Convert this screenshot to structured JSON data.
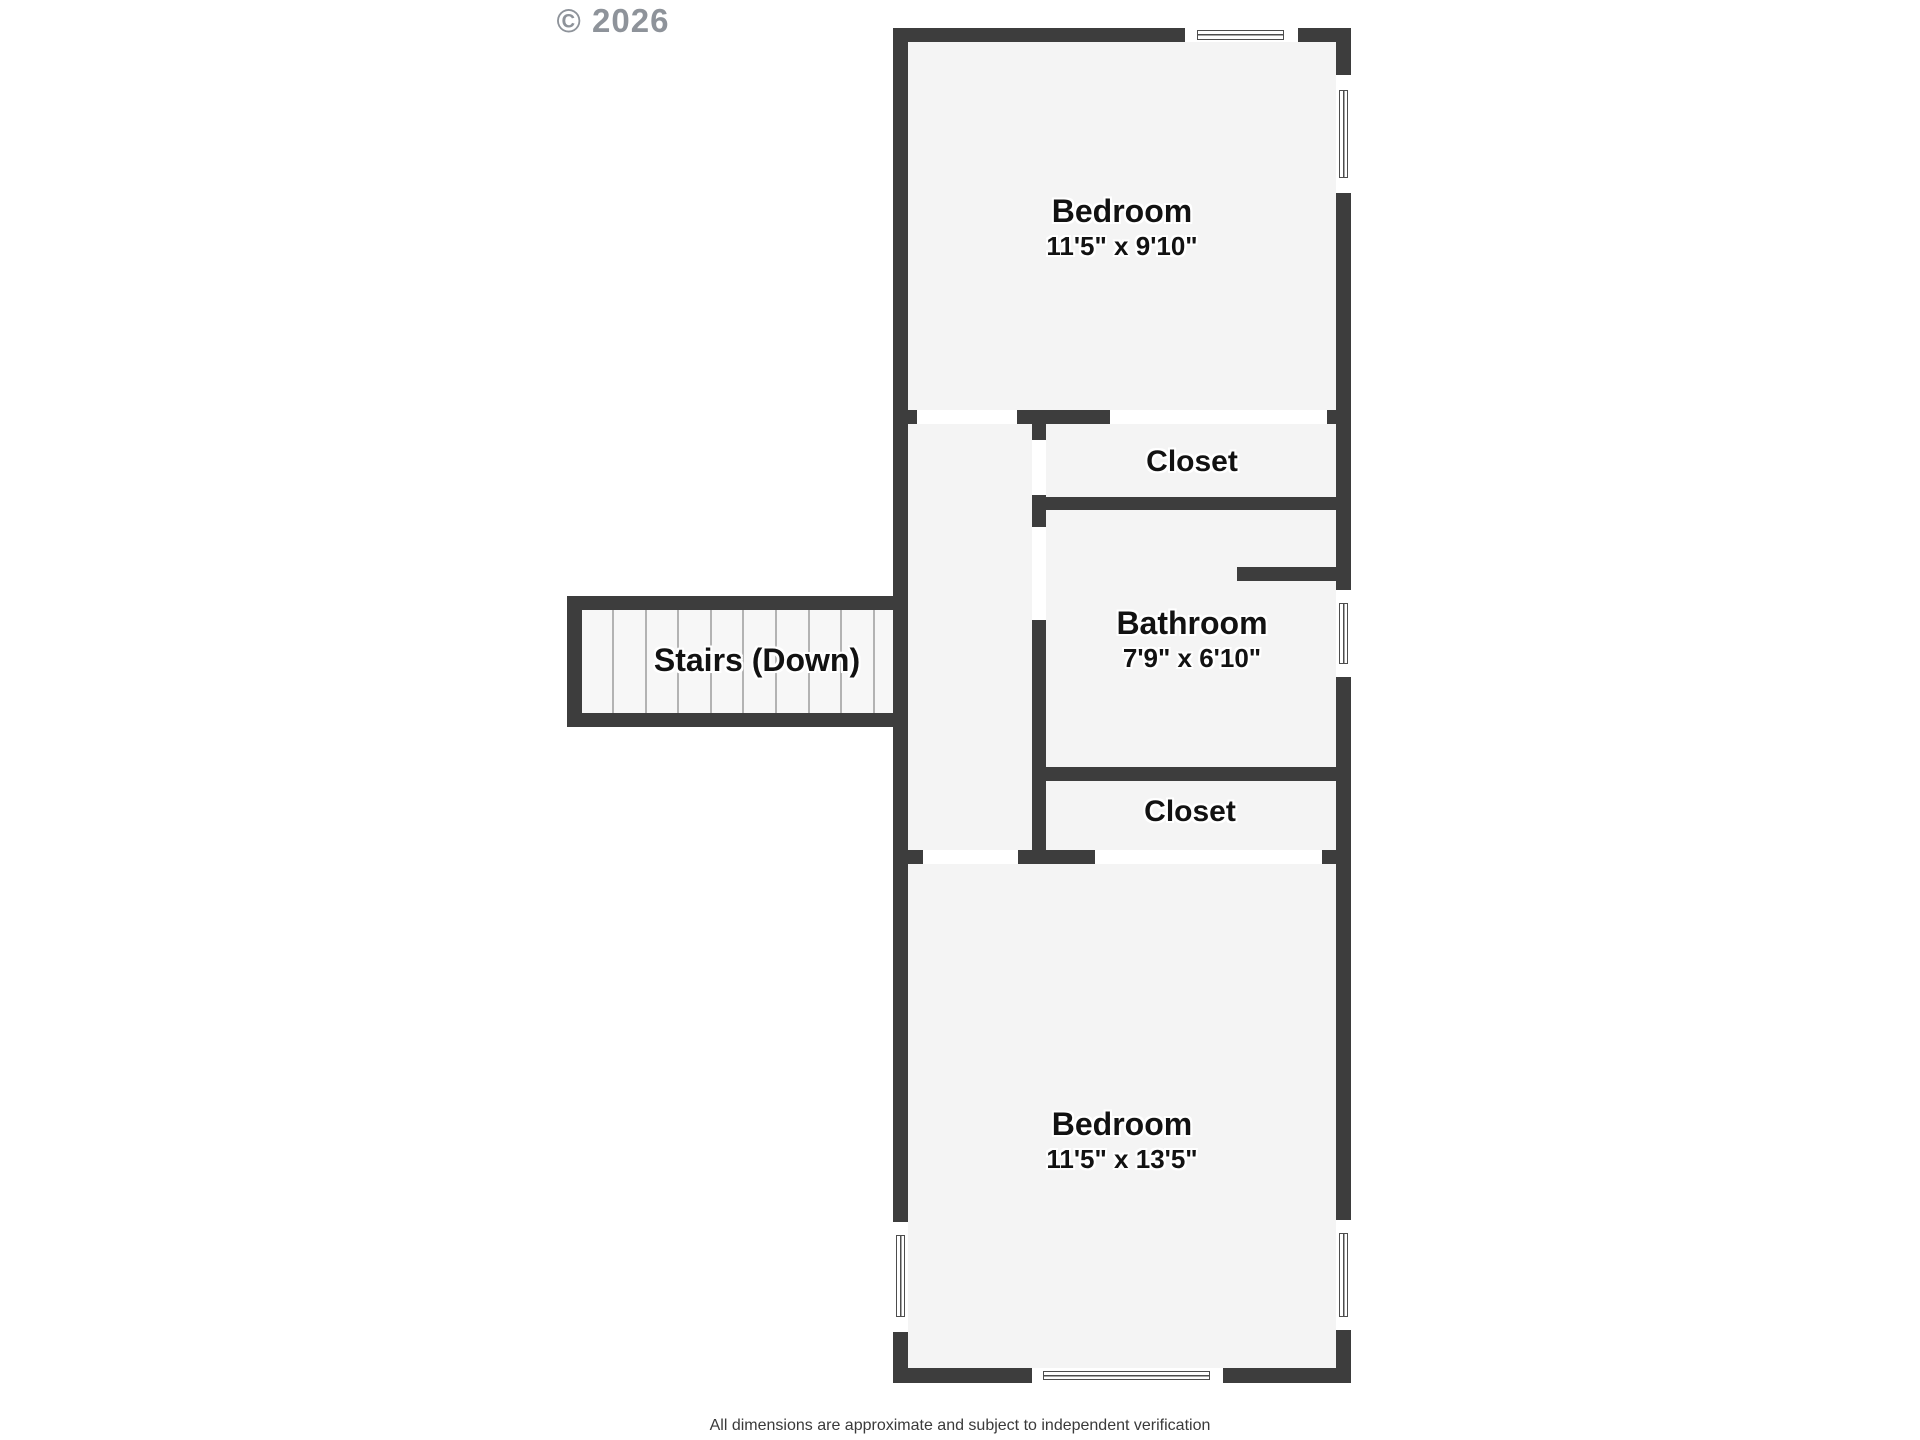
{
  "copyright": "© 2026",
  "footer": "All dimensions are approximate and subject to independent verification",
  "colors": {
    "wall": "#3d3d3d",
    "room_fill": "#f4f4f4",
    "stairs_fill": "#f7f7f7",
    "door_opening": "#ffffff",
    "window_frame": "#4d4d4d",
    "tread_line": "#b3b3b3",
    "label_text": "#121212",
    "copyright_text": "#8e939a",
    "footer_text": "#3a3a3a"
  },
  "rooms": {
    "bedroom_top": {
      "name": "Bedroom",
      "dims": "11'5\" x 9'10\""
    },
    "closet_top": {
      "name": "Closet"
    },
    "bathroom": {
      "name": "Bathroom",
      "dims": "7'9\" x 6'10\""
    },
    "closet_bottom": {
      "name": "Closet"
    },
    "bedroom_bottom": {
      "name": "Bedroom",
      "dims": "11'5\" x 13'5\""
    },
    "stairs": {
      "name": "Stairs (Down)",
      "tread_lines": 9
    }
  }
}
